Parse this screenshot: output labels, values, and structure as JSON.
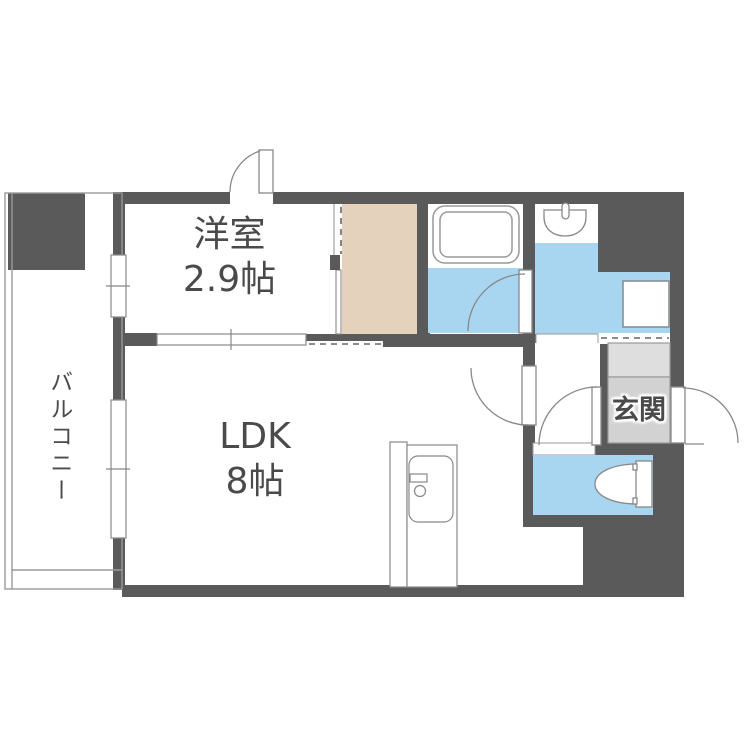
{
  "rooms": {
    "western": {
      "name": "洋室",
      "size": "2.9帖"
    },
    "ldk": {
      "name": "LDK",
      "size": "8帖"
    },
    "balcony": {
      "name": "バルコニー"
    },
    "entrance": {
      "name": "玄関"
    }
  },
  "fixtures": [
    "bathtub",
    "washbasin",
    "toilet",
    "kitchen-sink",
    "washing-machine-pan"
  ],
  "colors": {
    "wall": "#5a5a5a",
    "water_floor": "#a8d6f0",
    "closet_floor": "#e4d2bc",
    "entrance_floor": "#d2d2d2",
    "entrance_step": "#dedede",
    "line": "#999999",
    "fixture_line": "#888888",
    "text": "#4a4a4a"
  }
}
